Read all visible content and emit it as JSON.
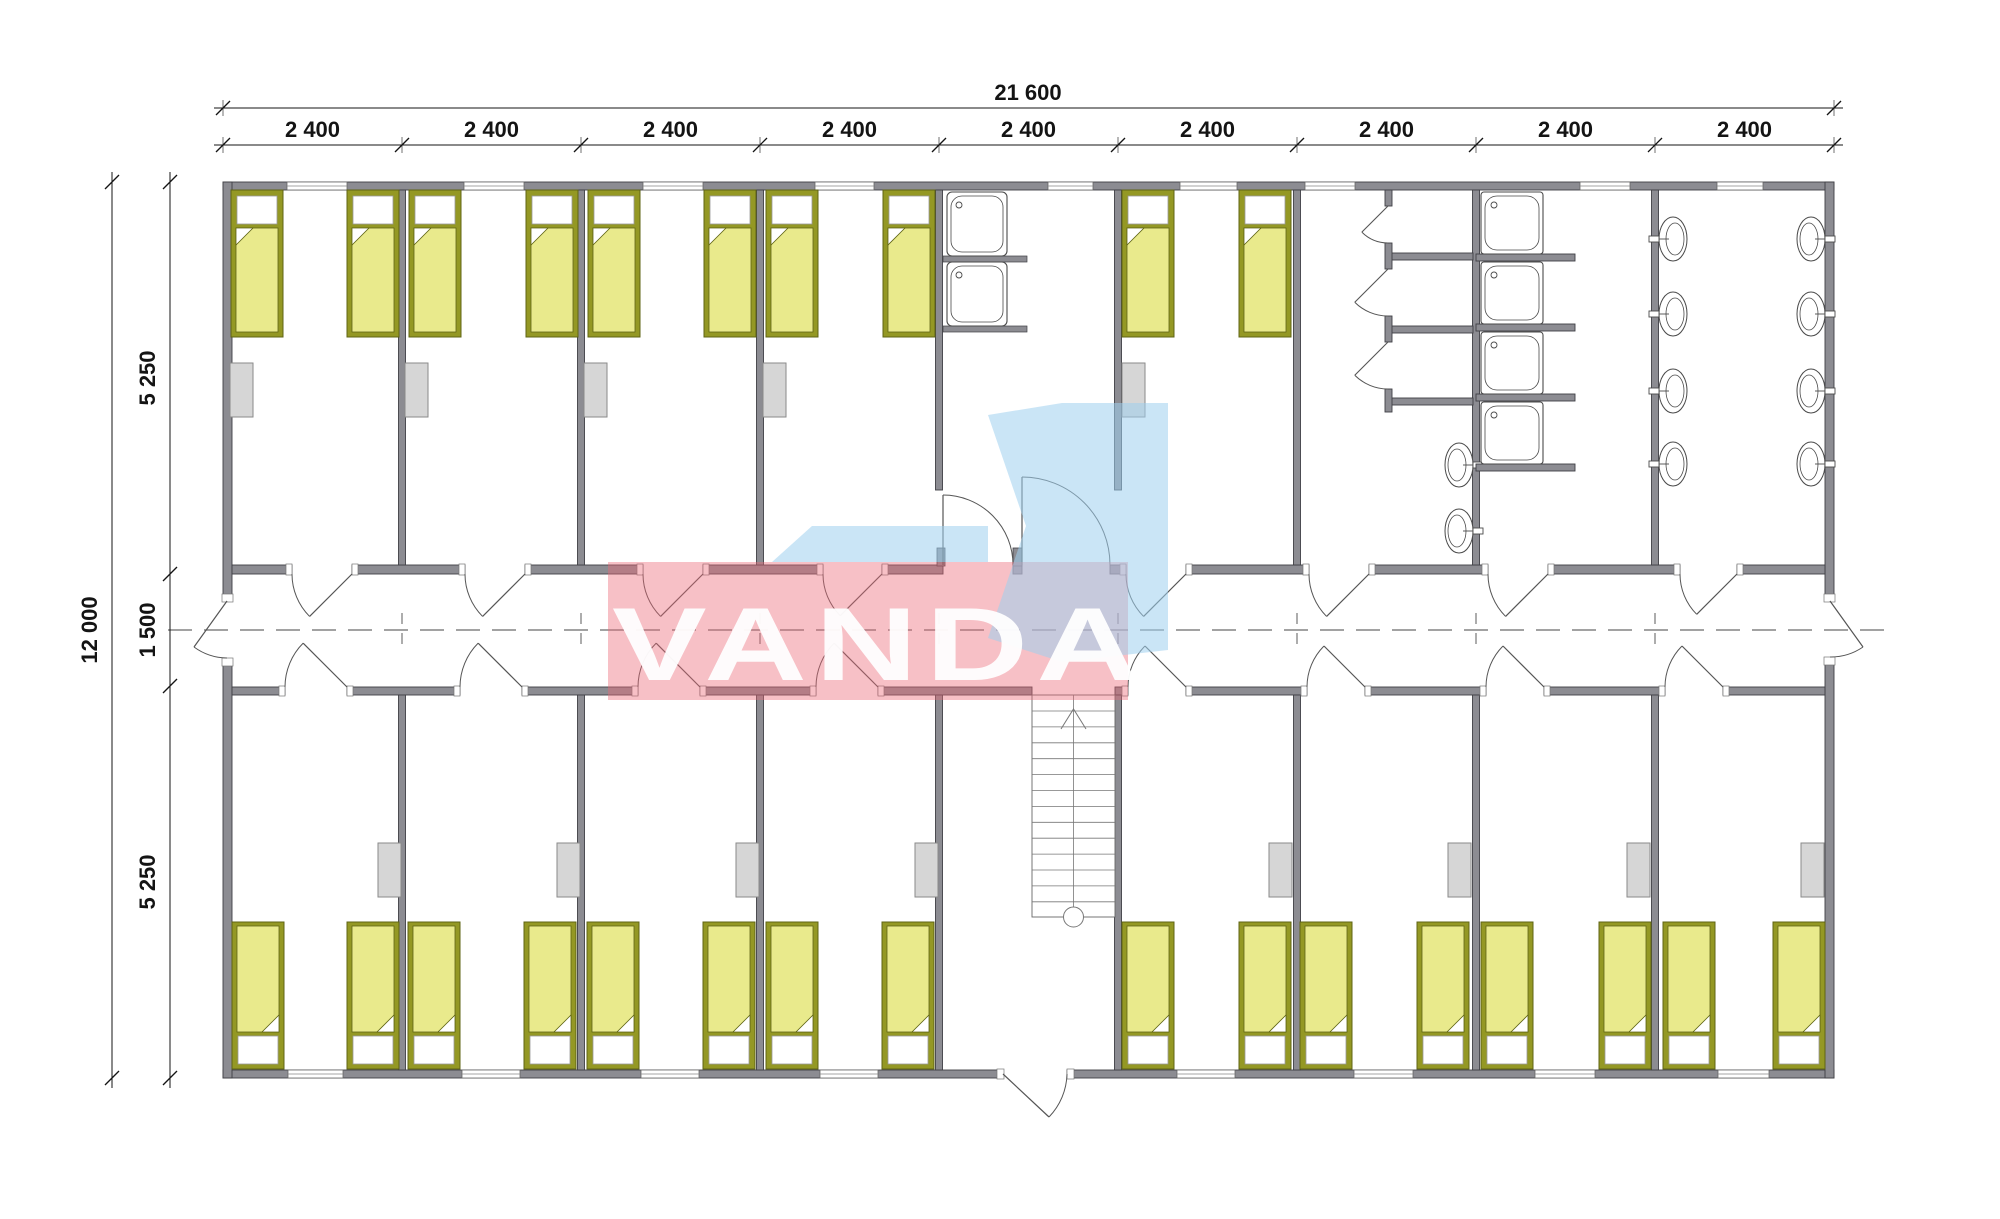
{
  "document": {
    "title": "Modular dormitory floor plan",
    "type": "architectural-floor-plan"
  },
  "dimensions": {
    "overall_width": {
      "label": "21 600"
    },
    "overall_height": {
      "label": "12 000"
    },
    "module_labels": [
      "2 400",
      "2 400",
      "2 400",
      "2 400",
      "2 400",
      "2 400",
      "2 400",
      "2 400",
      "2 400"
    ],
    "vertical_segments": [
      "5 250",
      "1 500",
      "5 250"
    ]
  },
  "watermark": {
    "text": "VANDA",
    "pink_color": "#ec6978",
    "blue_color": "#9fd0ee",
    "text_color": "#ffffff"
  },
  "plan": {
    "modules": 9,
    "corridor": {
      "position": "center",
      "width_label": "1 500"
    },
    "top_rooms": [
      {
        "type": "bedroom",
        "beds": 2,
        "wardrobe": true
      },
      {
        "type": "bedroom",
        "beds": 2,
        "wardrobe": true
      },
      {
        "type": "bedroom",
        "beds": 2,
        "wardrobe": true
      },
      {
        "type": "bedroom",
        "beds": 2,
        "wardrobe": true
      },
      {
        "type": "utility-room",
        "sinks": 2
      },
      {
        "type": "bedroom",
        "beds": 2,
        "wardrobe": true
      },
      {
        "type": "toilet-room",
        "stalls": 3,
        "basins": 2
      },
      {
        "type": "shower-room",
        "showers": 4
      },
      {
        "type": "washroom",
        "basins": 8
      }
    ],
    "bottom_rooms": [
      {
        "type": "bedroom",
        "beds": 2,
        "wardrobe": true
      },
      {
        "type": "bedroom",
        "beds": 2,
        "wardrobe": true
      },
      {
        "type": "bedroom",
        "beds": 2,
        "wardrobe": true
      },
      {
        "type": "bedroom",
        "beds": 2,
        "wardrobe": true
      },
      {
        "type": "stair-hall",
        "staircase": true,
        "exterior_exit": true
      },
      {
        "type": "bedroom",
        "beds": 2,
        "wardrobe": true
      },
      {
        "type": "bedroom",
        "beds": 2,
        "wardrobe": true
      },
      {
        "type": "bedroom",
        "beds": 2,
        "wardrobe": true
      },
      {
        "type": "bedroom",
        "beds": 2,
        "wardrobe": true
      }
    ],
    "furniture_counts": {
      "beds": 26,
      "wardrobes": 13,
      "utility_sinks": 2,
      "shower_trays": 4,
      "wash_basins": 10,
      "toilet_stalls": 3,
      "staircases": 1,
      "exterior_doors": 3
    }
  },
  "colors": {
    "wall_fill": "#8c8c92",
    "wall_stroke": "#3f3f45",
    "bed_frame": "#949824",
    "bed_frame_stroke": "#5f6414",
    "bed_blanket": "#e9ea8c",
    "pillow": "#ffffff",
    "wardrobe_fill": "#d6d6d6",
    "wardrobe_stroke": "#8a8a8a",
    "fixture_stroke": "#4a4a4a",
    "door_stroke": "#555555",
    "centerline": "#6a6a6a",
    "dimension": "#141414",
    "background": "#ffffff"
  }
}
